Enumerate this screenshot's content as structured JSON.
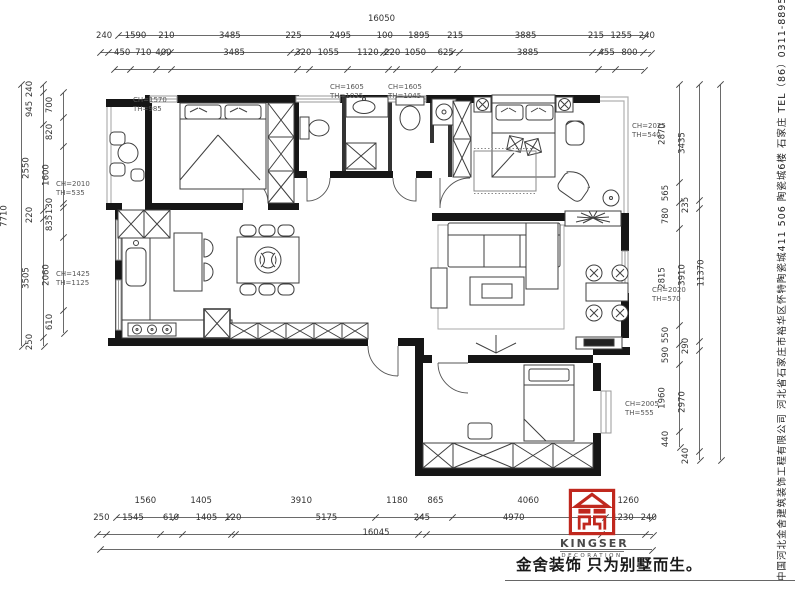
{
  "meta": {
    "drawing_type": "residential floor plan",
    "accent_red": "#c0281e",
    "wall_color": "#161616",
    "line_color": "#555555"
  },
  "dimensions": {
    "top_total": "16050",
    "top_row2": [
      "240",
      "1590",
      "210",
      "3485",
      "225",
      "2495",
      "100",
      "1895",
      "215",
      "3885",
      "215",
      "1255",
      "240"
    ],
    "top_row3": [
      "450",
      "710",
      "400",
      "3485",
      "320",
      "1055",
      "1120",
      "220",
      "1050",
      "625",
      "3885",
      "455",
      "800"
    ],
    "bottom_row1": [
      "1560",
      "1405",
      "3910",
      "1180",
      "865",
      "4060",
      "1260"
    ],
    "bottom_row2": [
      "250",
      "1545",
      "610",
      "1405",
      "120",
      "5175",
      "245",
      "4970",
      "1230",
      "240"
    ],
    "bottom_total": "16045",
    "left_total": "7710",
    "left_mid": [
      "240",
      "945",
      "2550",
      "220",
      "3505",
      "250"
    ],
    "left_inner": [
      "700",
      "820",
      "1600",
      "130",
      "835",
      "2060",
      "610"
    ],
    "right_inner": [
      "2870",
      "565",
      "780",
      "2815",
      "550",
      "590",
      "1960",
      "440"
    ],
    "right_mid": [
      "3435",
      "235",
      "3910",
      "290",
      "2970",
      "240"
    ],
    "right_total": "11370"
  },
  "window_labels": [
    {
      "ch": "CH=1570",
      "th": "TH=985",
      "x": 133,
      "y": 96
    },
    {
      "ch": "CH=1605",
      "th": "TH=1035",
      "x": 330,
      "y": 83
    },
    {
      "ch": "CH=1605",
      "th": "TH=1045",
      "x": 388,
      "y": 83
    },
    {
      "ch": "CH=2025",
      "th": "TH=540",
      "x": 632,
      "y": 122
    },
    {
      "ch": "CH=2010",
      "th": "TH=535",
      "x": 56,
      "y": 180
    },
    {
      "ch": "CH=1425",
      "th": "TH=1125",
      "x": 56,
      "y": 270
    },
    {
      "ch": "CH=2020",
      "th": "TH=570",
      "x": 652,
      "y": 286
    },
    {
      "ch": "CH=2005",
      "th": "TH=555",
      "x": 625,
      "y": 400
    }
  ],
  "branding": {
    "logo_icon": "kingser-emblem-icon",
    "logo_name": "KINGSER",
    "logo_subtitle": "DECORATION",
    "slogan": "金舍装饰 只为别墅而生。",
    "company_info": "中国河北金舍建筑装饰工程有限公司  河北省石家庄市裕华区怀特陶瓷城411 506 陶瓷城6楼  石家庄  TEL（86）0311-88955555"
  }
}
